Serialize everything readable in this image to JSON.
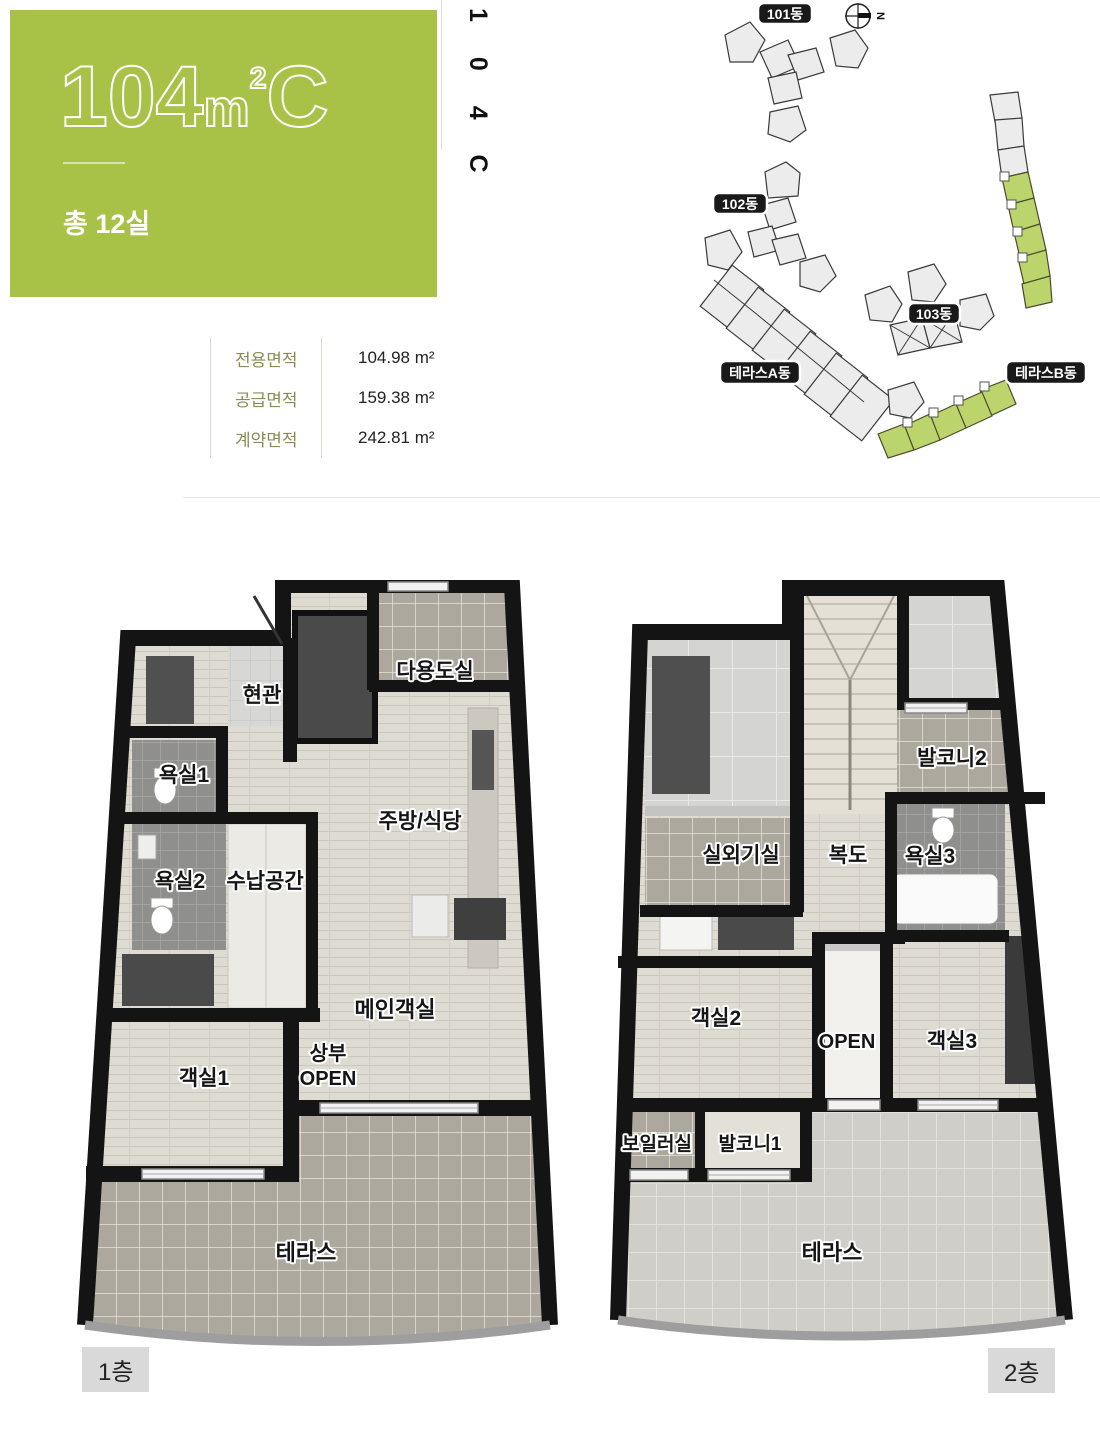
{
  "hero": {
    "accent_color": "#a7c247",
    "title": "104㎡C",
    "title_parts": {
      "number": "104",
      "unit": "m",
      "exponent": "2",
      "letter": "C"
    },
    "subtitle": "총 12실"
  },
  "vertical_code": "1 0 4 C",
  "site_map": {
    "north_label": "N",
    "highlight_color": "#bcd46c",
    "badges": [
      "101동",
      "102동",
      "103동",
      "테라스A동",
      "테라스B동"
    ]
  },
  "area_table": {
    "rows": [
      {
        "label": "전용면적",
        "value": "104.98",
        "unit": "m²"
      },
      {
        "label": "공급면적",
        "value": "159.38",
        "unit": "m²"
      },
      {
        "label": "계약면적",
        "value": "242.81",
        "unit": "m²"
      }
    ]
  },
  "floor1": {
    "badge": "1층",
    "rooms": {
      "entry": "현관",
      "utility": "다용도실",
      "bath1": "욕실1",
      "kitchen": "주방/식당",
      "bath2": "욕실2",
      "storage": "수납공간",
      "main_room": "메인객실",
      "room1": "객실1",
      "upper_line1": "상부",
      "upper_line2": "OPEN",
      "terrace": "테라스"
    }
  },
  "floor2": {
    "badge": "2층",
    "rooms": {
      "outdoor_unit": "실외기실",
      "corridor": "복도",
      "balcony2": "발코니2",
      "bath3": "욕실3",
      "room2": "객실2",
      "open": "OPEN",
      "room3": "객실3",
      "boiler": "보일러실",
      "balcony1": "발코니1",
      "terrace": "테라스"
    }
  }
}
